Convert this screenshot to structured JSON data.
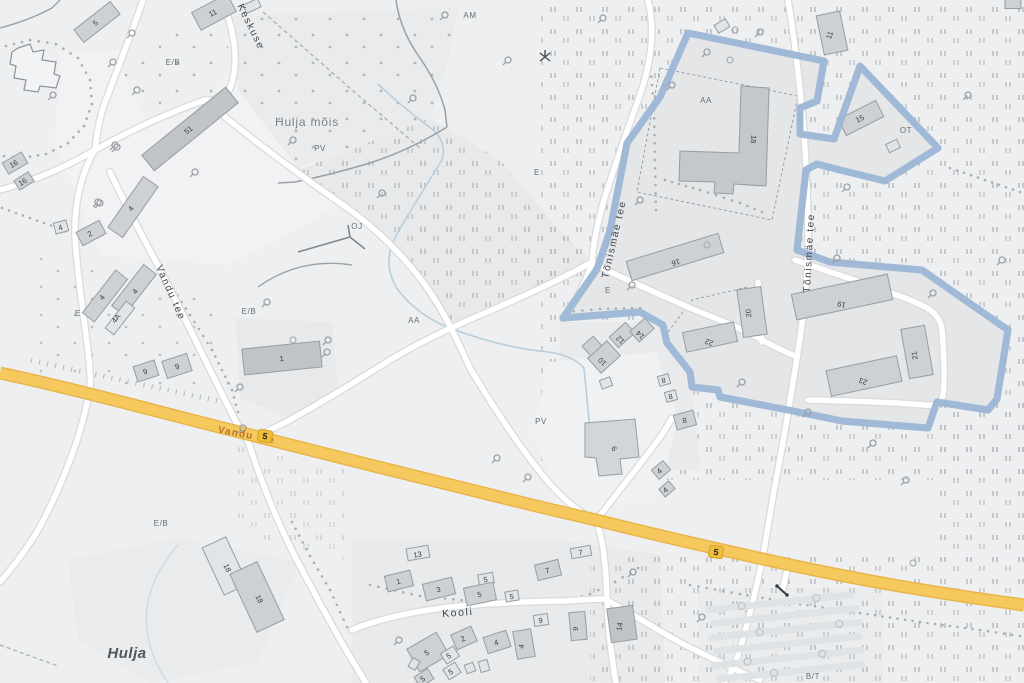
{
  "map": {
    "place_labels": [
      {
        "text": "Hulja",
        "x": 127,
        "y": 658,
        "rot": 0,
        "size": 15
      },
      {
        "text": "Hulja mõis",
        "x": 307,
        "y": 126,
        "rot": 0,
        "size": 12
      }
    ],
    "street_labels": [
      {
        "text": "Keskuse",
        "x": 248,
        "y": 28,
        "rot": 64,
        "size": 10
      },
      {
        "text": "Vandu tee",
        "x": 168,
        "y": 294,
        "rot": 66,
        "size": 10
      },
      {
        "text": "Tõnismäe tee",
        "x": 617,
        "y": 240,
        "rot": -77,
        "size": 10
      },
      {
        "text": "Tõnismäe tee",
        "x": 812,
        "y": 253,
        "rot": -87,
        "size": 10
      },
      {
        "text": "Kooli",
        "x": 458,
        "y": 616,
        "rot": -4,
        "size": 10.5
      }
    ],
    "highway_label": {
      "text": "Vandu tee",
      "x": 246,
      "y": 438,
      "rot": 11,
      "size": 10
    },
    "road_shields": [
      {
        "text": "5",
        "x": 265,
        "y": 436,
        "rot": 10
      },
      {
        "text": "5",
        "x": 716,
        "y": 552,
        "rot": 8
      }
    ],
    "area_labels": [
      {
        "text": "AM",
        "x": 470,
        "y": 18
      },
      {
        "text": "E/B",
        "x": 173,
        "y": 65
      },
      {
        "text": "PV",
        "x": 320,
        "y": 151
      },
      {
        "text": "E",
        "x": 537,
        "y": 175
      },
      {
        "text": "OJ",
        "x": 357,
        "y": 229
      },
      {
        "text": "AA",
        "x": 414,
        "y": 323
      },
      {
        "text": "AA",
        "x": 706,
        "y": 103
      },
      {
        "text": "E",
        "x": 608,
        "y": 293
      },
      {
        "text": "E",
        "x": 78,
        "y": 316
      },
      {
        "text": "E/B",
        "x": 249,
        "y": 314
      },
      {
        "text": "PV",
        "x": 541,
        "y": 424
      },
      {
        "text": "E/B",
        "x": 161,
        "y": 526
      },
      {
        "text": "OT",
        "x": 906,
        "y": 133
      },
      {
        "text": "B/T",
        "x": 813,
        "y": 679
      }
    ],
    "building_labels": [
      {
        "text": "5",
        "x": 97,
        "y": 25,
        "rot": -38
      },
      {
        "text": "11",
        "x": 214,
        "y": 15,
        "rot": -28
      },
      {
        "text": "51",
        "x": 190,
        "y": 132,
        "rot": -39
      },
      {
        "text": "16",
        "x": 15,
        "y": 166,
        "rot": -30
      },
      {
        "text": "16",
        "x": 24,
        "y": 184,
        "rot": -33
      },
      {
        "text": "4",
        "x": 61,
        "y": 230,
        "rot": -15
      },
      {
        "text": "4",
        "x": 133,
        "y": 210,
        "rot": -55
      },
      {
        "text": "2",
        "x": 91,
        "y": 236,
        "rot": -28
      },
      {
        "text": "4",
        "x": 104,
        "y": 299,
        "rot": -52
      },
      {
        "text": "4A",
        "x": 118,
        "y": 320,
        "rot": -52
      },
      {
        "text": "4",
        "x": 137,
        "y": 293,
        "rot": -52
      },
      {
        "text": "9",
        "x": 146,
        "y": 374,
        "rot": -18
      },
      {
        "text": "9",
        "x": 178,
        "y": 369,
        "rot": -18
      },
      {
        "text": "1",
        "x": 282,
        "y": 361,
        "rot": -6
      },
      {
        "text": "18",
        "x": 225,
        "y": 569,
        "rot": 65
      },
      {
        "text": "18",
        "x": 257,
        "y": 600,
        "rot": 65
      },
      {
        "text": "13",
        "x": 418,
        "y": 557,
        "rot": -10
      },
      {
        "text": "1",
        "x": 399,
        "y": 584,
        "rot": -14
      },
      {
        "text": "3",
        "x": 439,
        "y": 592,
        "rot": -14
      },
      {
        "text": "5",
        "x": 486,
        "y": 582,
        "rot": -10
      },
      {
        "text": "5",
        "x": 480,
        "y": 597,
        "rot": -12
      },
      {
        "text": "5",
        "x": 512,
        "y": 599,
        "rot": -10
      },
      {
        "text": "7",
        "x": 548,
        "y": 573,
        "rot": -14
      },
      {
        "text": "7",
        "x": 581,
        "y": 555,
        "rot": -10
      },
      {
        "text": "9",
        "x": 541,
        "y": 623,
        "rot": -8
      },
      {
        "text": "9",
        "x": 578,
        "y": 629,
        "rot": -85
      },
      {
        "text": "14",
        "x": 622,
        "y": 627,
        "rot": -80
      },
      {
        "text": "2",
        "x": 464,
        "y": 641,
        "rot": -24
      },
      {
        "text": "4",
        "x": 497,
        "y": 645,
        "rot": -18
      },
      {
        "text": "4",
        "x": 524,
        "y": 647,
        "rot": -80
      },
      {
        "text": "5",
        "x": 428,
        "y": 655,
        "rot": -30
      },
      {
        "text": "5",
        "x": 450,
        "y": 658,
        "rot": -32
      },
      {
        "text": "5",
        "x": 452,
        "y": 674,
        "rot": -32
      },
      {
        "text": "5",
        "x": 424,
        "y": 681,
        "rot": -32
      },
      {
        "text": "18",
        "x": 751,
        "y": 139,
        "rot": 95
      },
      {
        "text": "15",
        "x": 861,
        "y": 121,
        "rot": -27
      },
      {
        "text": "11",
        "x": 832,
        "y": 36,
        "rot": -70
      },
      {
        "text": "16",
        "x": 675,
        "y": 260,
        "rot": 163
      },
      {
        "text": "10",
        "x": 604,
        "y": 360,
        "rot": -135
      },
      {
        "text": "12",
        "x": 622,
        "y": 338,
        "rot": -135
      },
      {
        "text": "14",
        "x": 642,
        "y": 333,
        "rot": -135
      },
      {
        "text": "22",
        "x": 710,
        "y": 340,
        "rot": -160
      },
      {
        "text": "20",
        "x": 751,
        "y": 313,
        "rot": -95
      },
      {
        "text": "19",
        "x": 842,
        "y": 302,
        "rot": -168
      },
      {
        "text": "21",
        "x": 917,
        "y": 355,
        "rot": -100
      },
      {
        "text": "23",
        "x": 864,
        "y": 379,
        "rot": -160
      },
      {
        "text": "8",
        "x": 664,
        "y": 383,
        "rot": -12
      },
      {
        "text": "8",
        "x": 671,
        "y": 399,
        "rot": -12
      },
      {
        "text": "8",
        "x": 685,
        "y": 423,
        "rot": -12
      },
      {
        "text": "9",
        "x": 616,
        "y": 447,
        "rot": -130
      },
      {
        "text": "4",
        "x": 661,
        "y": 473,
        "rot": -40
      },
      {
        "text": "4",
        "x": 667,
        "y": 492,
        "rot": -40
      }
    ],
    "colors": {
      "boundary_core": "#2f5f9e",
      "boundary_halo": "#9db7d6",
      "highway_fill": "#f5c95e",
      "highway_casing": "#e9b54a",
      "shield_fill": "#f0bd3a",
      "building_dark": "#bfc4c8",
      "building_mid": "#cdd1d4",
      "building_light": "#e2e5e7"
    }
  }
}
